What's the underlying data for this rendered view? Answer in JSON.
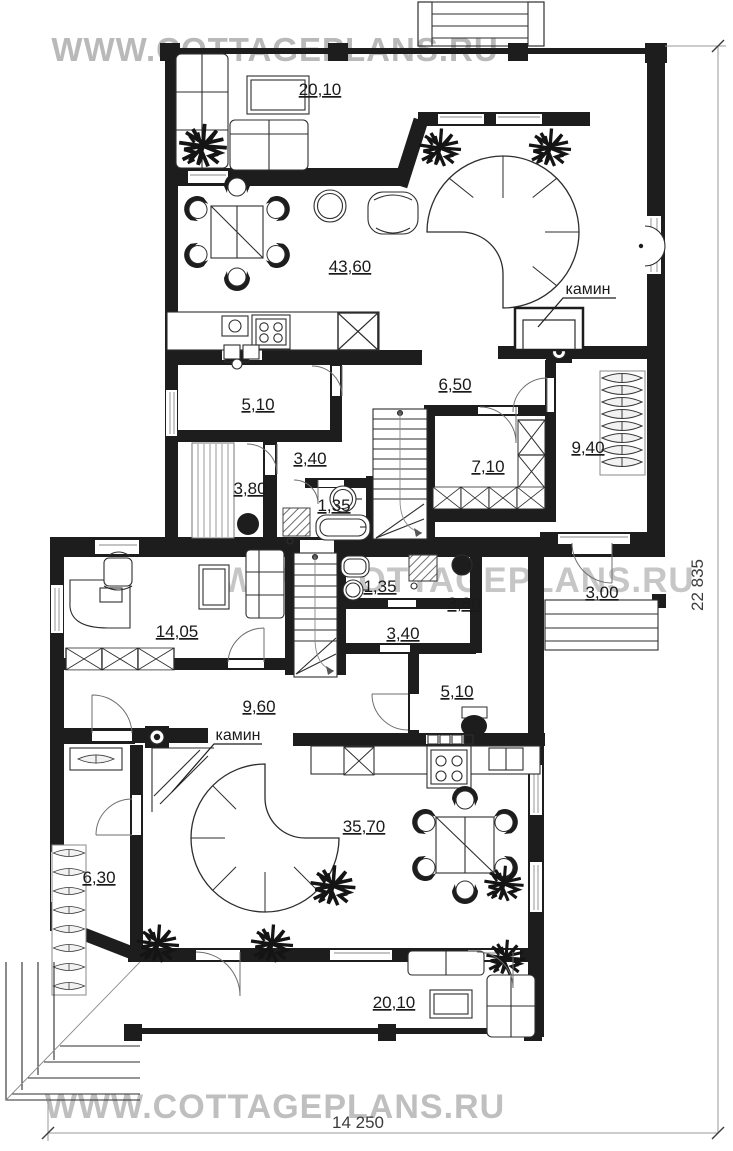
{
  "watermarks": {
    "top": "WWW.COTTAGEPLANS.RU",
    "middle": "WWW.COTTAGEPLANS.RU",
    "bottom": "WWW.COTTAGEPLANS.RU"
  },
  "dimensions": {
    "width": "14 250",
    "height": "22 835"
  },
  "labels": {
    "fireplace_upper": "камин",
    "fireplace_lower": "камин"
  },
  "rooms": [
    {
      "id": "terrace-top",
      "area": "20,10"
    },
    {
      "id": "living-dining",
      "area": "43,60"
    },
    {
      "id": "hall-upper",
      "area": "6,50"
    },
    {
      "id": "room-upper",
      "area": "5,10"
    },
    {
      "id": "corridor-upper",
      "area": "3,40"
    },
    {
      "id": "sauna-upper",
      "area": "3,80"
    },
    {
      "id": "wc-upper",
      "area": "1,35"
    },
    {
      "id": "wardrobe-upper",
      "area": "7,10"
    },
    {
      "id": "bedroom-right",
      "area": "9,40"
    },
    {
      "id": "study",
      "area": "14,05"
    },
    {
      "id": "wc-lower",
      "area": "1,35"
    },
    {
      "id": "sauna-lower",
      "area": "3,80"
    },
    {
      "id": "corridor-lower",
      "area": "3,40"
    },
    {
      "id": "porch-right",
      "area": "3,00"
    },
    {
      "id": "room-lower",
      "area": "5,10"
    },
    {
      "id": "hall-lower",
      "area": "9,60"
    },
    {
      "id": "wardrobe-lower",
      "area": "6,30"
    },
    {
      "id": "living-lower",
      "area": "35,70"
    },
    {
      "id": "terrace-bottom",
      "area": "20,10"
    }
  ],
  "colors": {
    "wall": "#1d1d1d",
    "watermark": "#c2c2c2",
    "dimension": "#3c3c3c",
    "paper": "#ffffff"
  }
}
